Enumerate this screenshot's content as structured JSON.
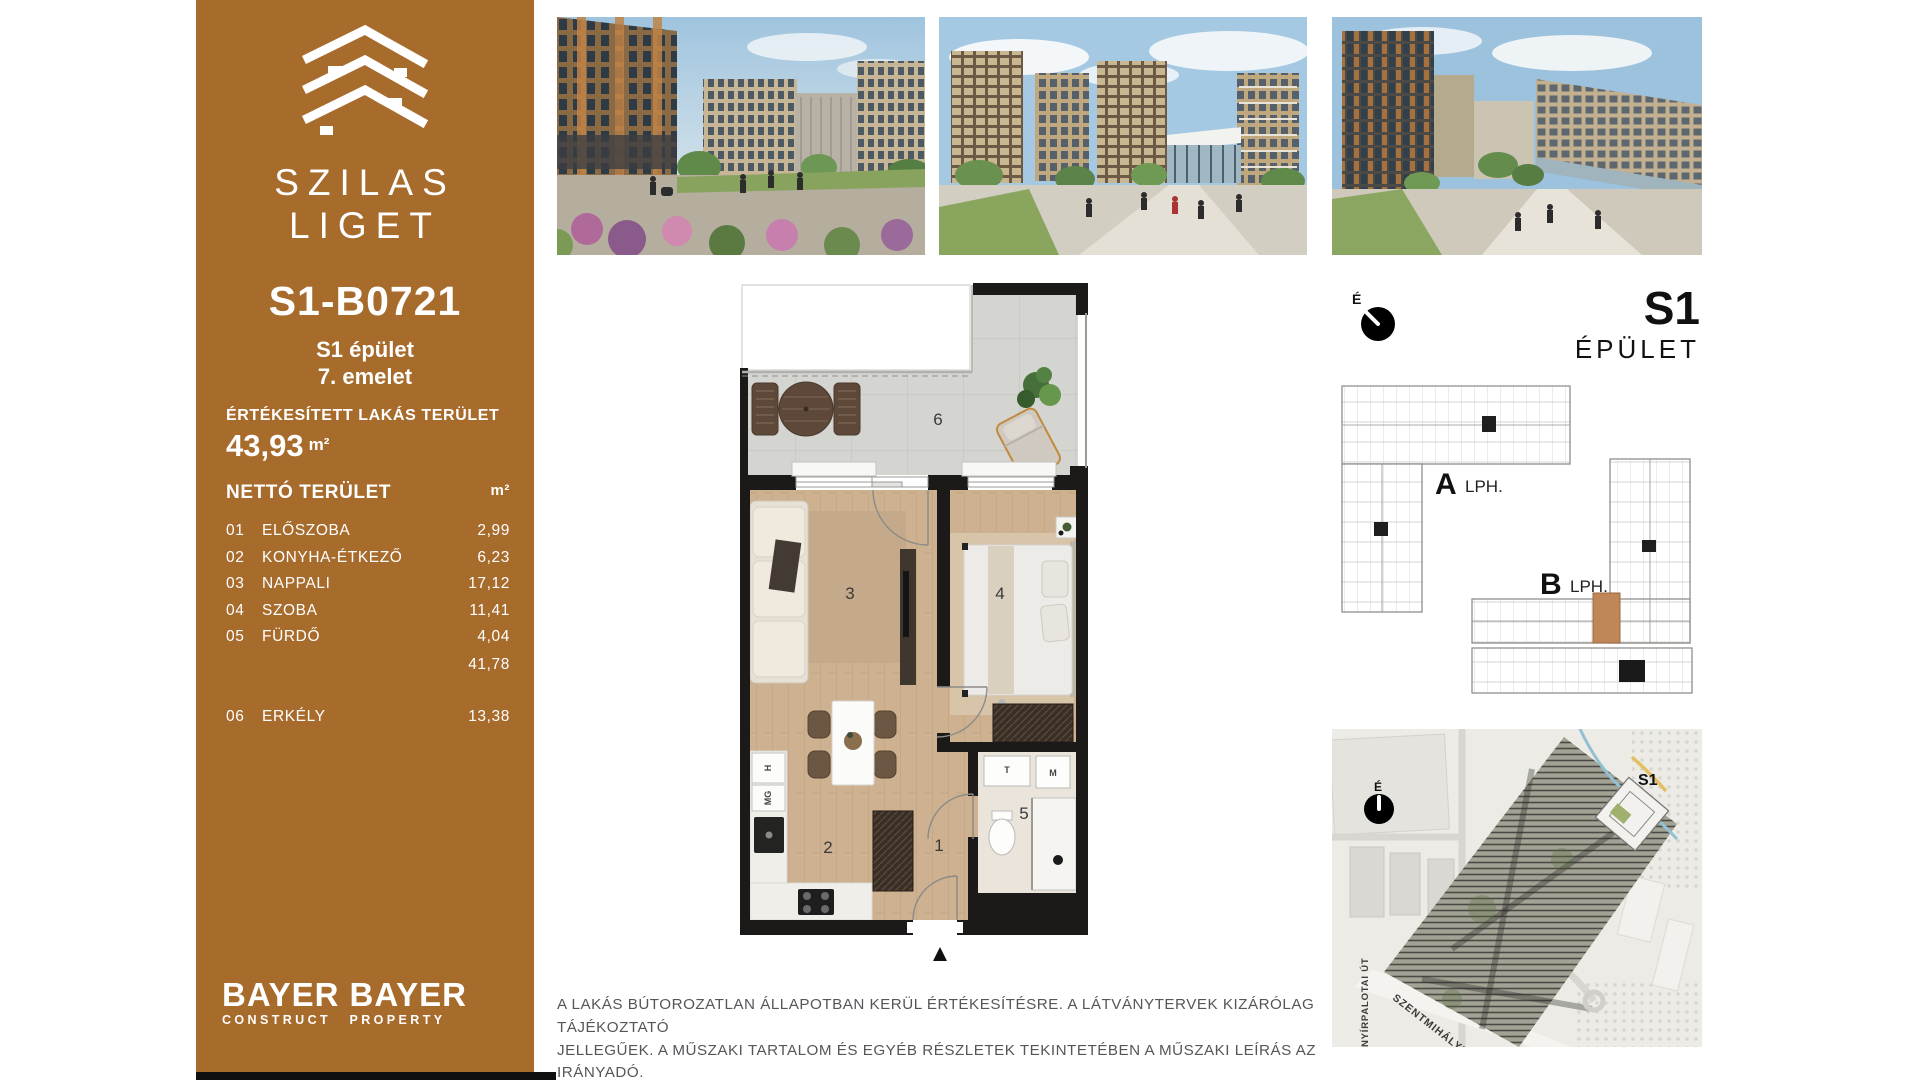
{
  "page": {
    "accent": "#a76b2c",
    "highlight": "#bf8757",
    "wall": "#1c1a18"
  },
  "sidebar": {
    "brand_line1": "SZILAS",
    "brand_line2": "LIGET",
    "unit_code": "S1-B0721",
    "building": "S1 épület",
    "floor": "7. emelet",
    "sold_area_label": "ÉRTÉKESÍTETT LAKÁS TERÜLET",
    "sold_area_value": "43,93",
    "area_unit": "m²",
    "net_area_label": "NETTÓ TERÜLET",
    "net_area_unit": "m²",
    "rooms": [
      {
        "num": "01",
        "name": "ELŐSZOBA",
        "area": "2,99"
      },
      {
        "num": "02",
        "name": "KONYHA-ÉTKEZŐ",
        "area": "6,23"
      },
      {
        "num": "03",
        "name": "NAPPALI",
        "area": "17,12"
      },
      {
        "num": "04",
        "name": "SZOBA",
        "area": "11,41"
      },
      {
        "num": "05",
        "name": "FÜRDŐ",
        "area": "4,04"
      }
    ],
    "subtotal": "41,78",
    "balcony_room": {
      "num": "06",
      "name": "ERKÉLY",
      "area": "13,38"
    },
    "logo1_line1": "BAYER",
    "logo1_line2": "CONSTRUCT",
    "logo2_line1": "BAYER",
    "logo2_line2": "PROPERTY"
  },
  "floorplan": {
    "compass_label": "É",
    "room_numbers": [
      "1",
      "2",
      "3",
      "4",
      "5",
      "6"
    ],
    "fixture_labels": {
      "fridge": "H",
      "dishwasher": "MG",
      "basin": "T",
      "washer": "M"
    }
  },
  "keyplan": {
    "building_code": "S1",
    "building_word": "ÉPÜLET",
    "stair_a_letter": "A",
    "stair_a_suffix": "LPH.",
    "stair_b_letter": "B",
    "stair_b_suffix": "LPH."
  },
  "sitemap": {
    "compass_label": "É",
    "building_label": "S1",
    "street_diagonal": "SZENTMIHÁLYI ÚT",
    "street_vertical": "NYÍRPALOTAI ÚT"
  },
  "disclaimer": {
    "line1": "A LAKÁS BÚTOROZATLAN ÁLLAPOTBAN KERÜL ÉRTÉKESÍTÉSRE. A LÁTVÁNYTERVEK KIZÁRÓLAG TÁJÉKOZTATÓ",
    "line2": "JELLEGŰEK. A MŰSZAKI TARTALOM ÉS EGYÉB RÉSZLETEK TEKINTETÉBEN A MŰSZAKI LEÍRÁS AZ IRÁNYADÓ."
  }
}
